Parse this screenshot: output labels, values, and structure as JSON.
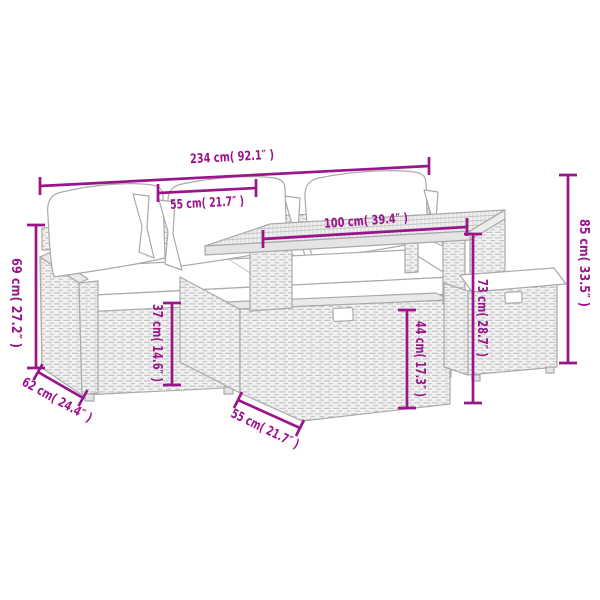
{
  "diagram": {
    "type": "product-dimension-diagram",
    "subject": "poly rattan garden lounge set with cushions, storage table and ottoman",
    "background": "#ffffff",
    "accent_color": "#9a148a",
    "line_art_color": "#a9a9a9",
    "cushion_color": "#ffffff"
  },
  "dimensions": {
    "overall_width": "234 cm( 92.1″ )",
    "seat_width": "55 cm( 21.7″ )",
    "table_width": "100 cm( 39.4″ )",
    "overall_height": "85 cm( 33.5″ )",
    "table_height": "73 cm( 28.7″ )",
    "storage_height": "44 cm( 17.3″ )",
    "seat_height": "37 cm( 14.6″ )",
    "back_height": "69 cm( 27.2″ )",
    "sofa_depth": "62 cm( 24.4″ )",
    "table_depth": "55 cm( 21.7″ )"
  }
}
